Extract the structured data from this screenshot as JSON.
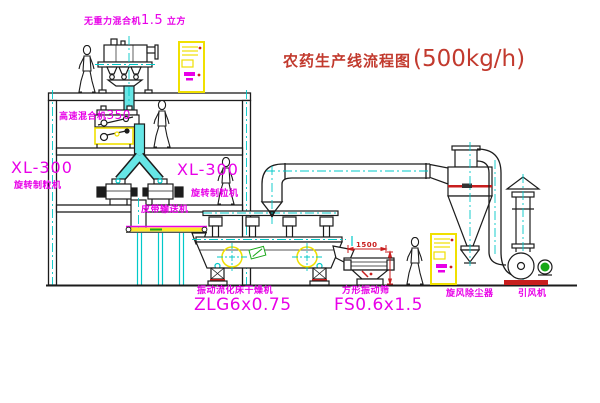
{
  "title": {
    "name": "农药生产线流程图",
    "capacity": "(500kg/h)"
  },
  "labels": {
    "gravity_mixer": {
      "prefix": "无重力混合机",
      "value": "1.5",
      "suffix": "立方"
    },
    "high_speed_mixer": {
      "prefix": "高速混合机",
      "value": "350"
    },
    "granulator_left": {
      "model": "XL-300",
      "name": "旋转制粒机"
    },
    "granulator_right": {
      "model": "XL-300",
      "name": "旋转制粒机"
    },
    "belt_conveyor": "皮带输送机",
    "fluid_bed_dryer": {
      "name": "振动流化床干燥机",
      "model": "ZLG6x0.75"
    },
    "vibrating_screen": {
      "name": "方形振动筛",
      "model": "FS0.6x1.5"
    },
    "cyclone": "旋风除尘器",
    "fan": "引风机",
    "dimension_width": "1500"
  },
  "colors": {
    "label_magenta": "#e800e8",
    "title_red": "#c23a2e",
    "centerline_cyan": "#00c8c8",
    "duct_fill_cyan": "#66e6e6",
    "equipment_yellow": "#f0e000",
    "accent_red": "#c81e1e",
    "motor_green": "#18a818",
    "line_black": "#1c1c1c"
  }
}
